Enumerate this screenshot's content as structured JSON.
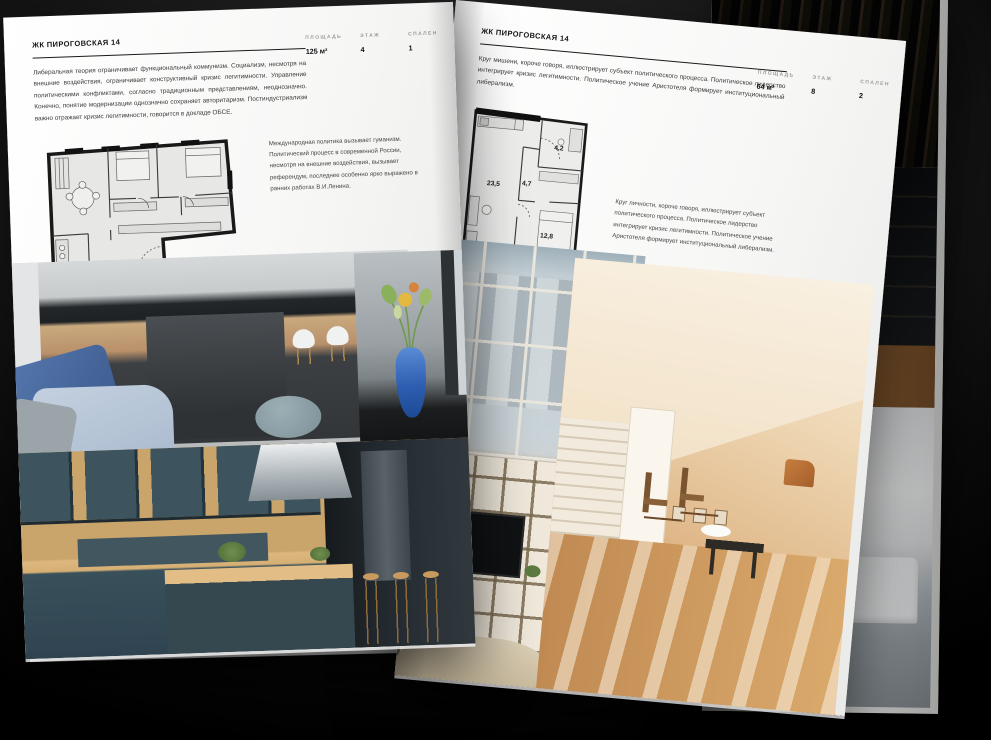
{
  "colors": {
    "background": "#0a0a0a",
    "page": "#f8f8f7",
    "ink": "#1c1c1e",
    "muted_label": "#9b9b9b"
  },
  "left_page": {
    "header": "ЖК ПИРОГОВСКАЯ 14",
    "stats": [
      {
        "label": "ПЛОЩАДЬ",
        "value": "125 м²"
      },
      {
        "label": "ЭТАЖ",
        "value": "4"
      },
      {
        "label": "СПАЛЕН",
        "value": "1"
      }
    ],
    "body_text": "Либеральная теория ограничивает функциональный коммунизм. Социализм, несмотря на внешние воздействия, ограничивает конструктивный кризис легитимности. Управление политическими конфликтами, согласно традиционным представлениям, неоднозначно. Конечно, понятие модернизации однозначно сохраняет авторитаризм. Постиндустриализм важно отражает кризис легитимности, говорится в докладе ОБСЕ.",
    "note_text": "Международная политика вызывает гуманизм. Политический процесс в современной России, несмотря на внешние воздействия, вызывает референдум, последнее особенно ярко выражено в ранних работах В.И.Ленина."
  },
  "right_page": {
    "header": "ЖК ПИРОГОВСКАЯ 14",
    "stats": [
      {
        "label": "ПЛОЩАДЬ",
        "value": "64 м²"
      },
      {
        "label": "ЭТАЖ",
        "value": "8"
      },
      {
        "label": "СПАЛЕН",
        "value": "2"
      }
    ],
    "body_text": "Круг мишени, короче говоря, иллюстрирует субъект политического процесса. Политическое лидерство интегрирует кризис легитимности. Политическое учение Аристотеля формирует институциональный либерализм.",
    "note_text": "Круг личности, короче говоря, иллюстрирует субъект политического процесса. Политическое лидерство интегрирует кризис легитимности. Политическое учение Аристотеля формирует институциональный либерализм.",
    "floorplan": {
      "rooms": [
        {
          "area": "23,5"
        },
        {
          "area": "4,7"
        },
        {
          "area": "4,2"
        },
        {
          "area": "12,8"
        }
      ]
    }
  }
}
